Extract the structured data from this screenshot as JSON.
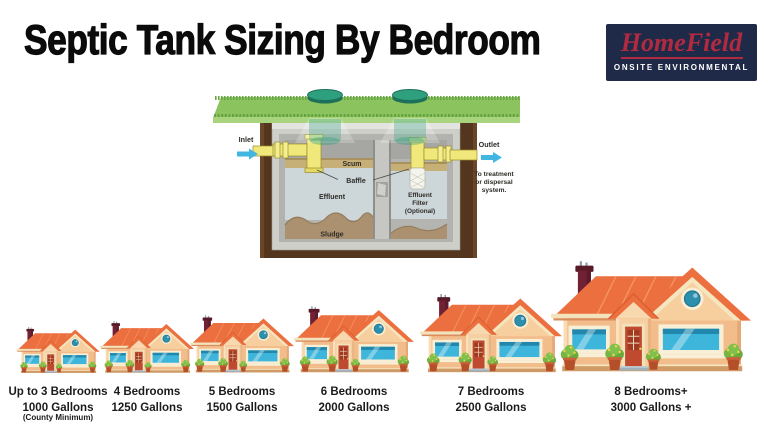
{
  "header": {
    "title": "Septic Tank Sizing By Bedroom",
    "logo": {
      "name": "HomeField",
      "tagline": "ONSITE ENVIRONMENTAL",
      "bg_color": "#1f2a48",
      "accent_color": "#b12a40"
    }
  },
  "diagram": {
    "inlet": "Inlet",
    "outlet": "Outlet",
    "outlet_note1": "To treatment",
    "outlet_note2": "or dispersal",
    "outlet_note3": "system.",
    "scum": "Scum",
    "baffle": "Baffle",
    "effluent": "Effluent",
    "sludge": "Sludge",
    "filter1": "Effluent",
    "filter2": "Filter",
    "filter3": "(Optional)",
    "colors": {
      "arrow_blue": "#41b6e2",
      "grass_green": "#8bc35e",
      "soil_brown": "#54351d",
      "pipe_yellow": "#f0e87a",
      "scum_tan": "#c6b078",
      "effluent_gray": "#cdd6d9",
      "sludge_brown": "#ab9170"
    }
  },
  "houses": [
    {
      "bedrooms": "Up to 3 Bedrooms",
      "gallons": "1000 Gallons",
      "note": "(County Minimum)"
    },
    {
      "bedrooms": "4 Bedrooms",
      "gallons": "1250 Gallons"
    },
    {
      "bedrooms": "5 Bedrooms",
      "gallons": "1500 Gallons"
    },
    {
      "bedrooms": "6 Bedrooms",
      "gallons": "2000 Gallons"
    },
    {
      "bedrooms": "7 Bedrooms",
      "gallons": "2500 Gallons"
    },
    {
      "bedrooms": "8 Bedrooms+",
      "gallons": "3000 Gallons +"
    }
  ]
}
